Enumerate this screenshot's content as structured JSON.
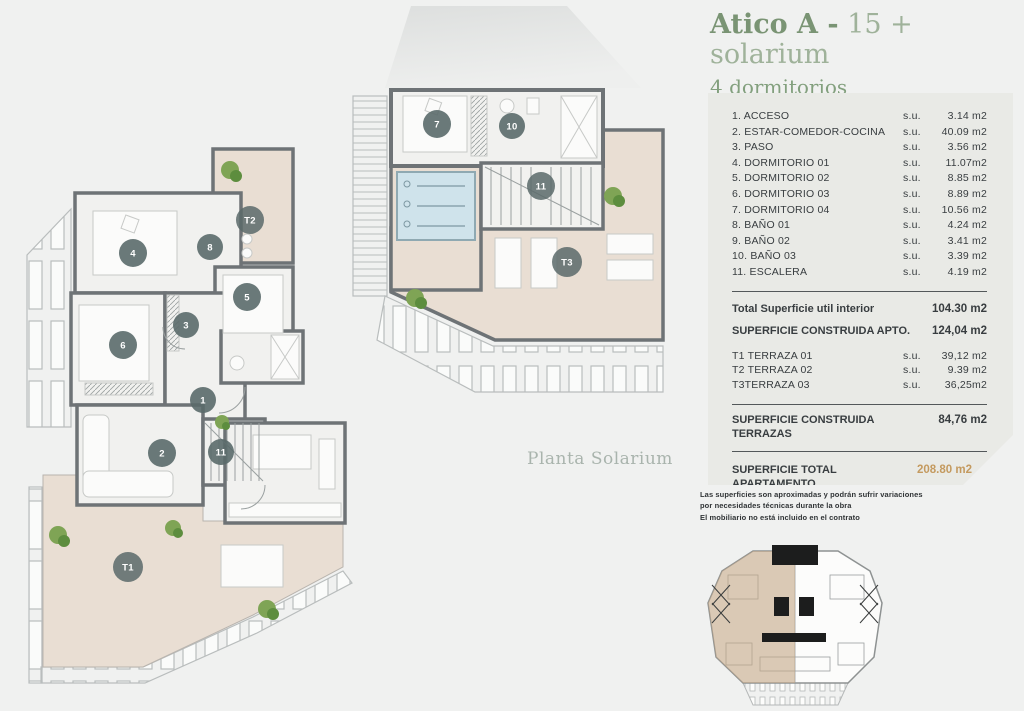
{
  "header": {
    "title_bold": "Atico A -",
    "title_light": " 15 + solarium",
    "subtitle": "4 dormitorios"
  },
  "plans": {
    "solarium_label": "Planta Solarium",
    "main_markers": [
      {
        "label": "4"
      },
      {
        "label": "8"
      },
      {
        "label": "T2"
      },
      {
        "label": "5"
      },
      {
        "label": "3"
      },
      {
        "label": "6"
      },
      {
        "label": "1"
      },
      {
        "label": "2"
      },
      {
        "label": "11"
      },
      {
        "label": "T1"
      }
    ],
    "solarium_markers": [
      {
        "label": "7"
      },
      {
        "label": "10"
      },
      {
        "label": "11"
      },
      {
        "label": "T3"
      }
    ]
  },
  "areas_table": {
    "rooms": [
      {
        "label": "1. ACCESO",
        "su": "s.u.",
        "amount": "3.14 m2"
      },
      {
        "label": "2. ESTAR-COMEDOR-COCINA",
        "su": "s.u.",
        "amount": "40.09 m2"
      },
      {
        "label": "3. PASO",
        "su": "s.u.",
        "amount": "3.56 m2"
      },
      {
        "label": "4. DORMITORIO 01",
        "su": "s.u.",
        "amount": "11.07m2"
      },
      {
        "label": "5. DORMITORIO 02",
        "su": "s.u.",
        "amount": "8.85 m2"
      },
      {
        "label": "6. DORMITORIO 03",
        "su": "s.u.",
        "amount": "8.89 m2"
      },
      {
        "label": "7. DORMITORIO 04",
        "su": "s.u.",
        "amount": "10.56 m2"
      },
      {
        "label": "8. BAÑO 01",
        "su": "s.u.",
        "amount": "4.24 m2"
      },
      {
        "label": "9. BAÑO 02",
        "su": "s.u.",
        "amount": "3.41 m2"
      },
      {
        "label": "10. BAÑO 03",
        "su": "s.u.",
        "amount": "3.39 m2"
      },
      {
        "label": "11. ESCALERA",
        "su": "s.u.",
        "amount": "4.19 m2"
      }
    ],
    "total_util": {
      "label": "Total Superficie util interior",
      "amount": "104.30 m2"
    },
    "construida_apto": {
      "label": "SUPERFICIE CONSTRUIDA APTO.",
      "amount": "124,04 m2"
    },
    "terraces": [
      {
        "label": "T1 TERRAZA 01",
        "su": "s.u.",
        "amount": "39,12 m2"
      },
      {
        "label": "T2 TERRAZA 02",
        "su": "s.u.",
        "amount": "9.39 m2"
      },
      {
        "label": "T3TERRAZA 03",
        "su": "s.u.",
        "amount": "36,25m2"
      }
    ],
    "construida_terrazas": {
      "label": "SUPERFICIE CONSTRUIDA TERRAZAS",
      "amount": "84,76 m2"
    },
    "total_apartamento": {
      "label": "SUPERFICIE TOTAL APARTAMENTO",
      "amount": "208.80 m2"
    }
  },
  "disclaimer": {
    "line1": "Las superficies son aproximadas y podrán sufrir variaciones",
    "line2": "por necesidades técnicas durante la obra",
    "line3": "El mobiliario no está incluido en el contrato"
  },
  "colors": {
    "accent_green": "#7a9474",
    "muted_green": "#9fb29a",
    "gold": "#c49a5f",
    "panel_bg": "#e9eae6",
    "wall": "#6e7376",
    "terrace": "#e9ded3"
  }
}
